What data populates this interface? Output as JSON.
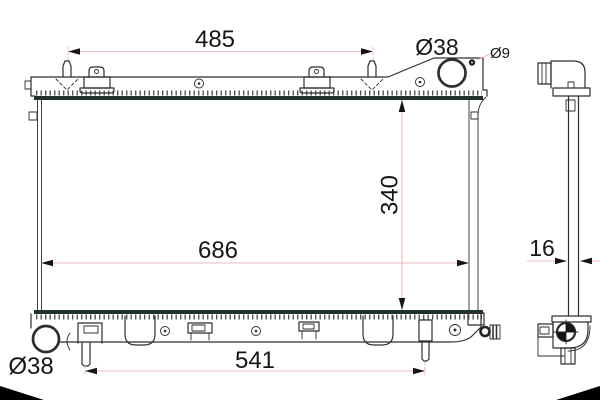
{
  "dimensions": {
    "top_mount_span": "485",
    "filler_neck_diameter": "Ø38",
    "pin_hole_diameter": "Ø9",
    "core_height": "340",
    "core_width": "686",
    "core_thickness": "16",
    "bottom_mount_span": "541",
    "outlet_diameter": "Ø38"
  },
  "colors": {
    "background": "#ffffff",
    "line": "#2e2e2e",
    "tank_edge_dark": "#20312a",
    "hatch": "#555555",
    "dimension_line": "#eebbbb",
    "text": "#161616",
    "corner_mark": "#000000"
  }
}
